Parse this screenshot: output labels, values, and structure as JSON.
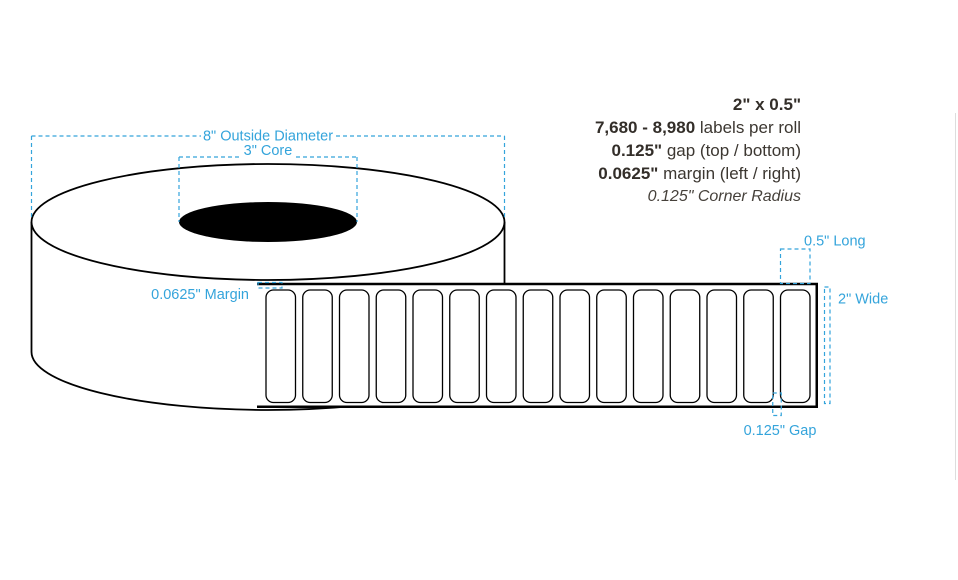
{
  "specs": {
    "size": "2\" x 0.5\"",
    "labels_range": "7,680 - 8,980",
    "labels_suffix": " labels per roll",
    "gap_value": "0.125\"",
    "gap_suffix": " gap (top / bottom)",
    "margin_value": "0.0625\"",
    "margin_suffix": " margin (left / right)",
    "corner_radius_note": "0.125\" Corner Radius"
  },
  "annotations": {
    "outside_diameter": "8\" Outside Diameter",
    "core": "3\" Core",
    "margin": "0.0625\" Margin",
    "long": "0.5\" Long",
    "wide": "2\" Wide",
    "gap": "0.125\" Gap"
  },
  "diagram": {
    "label_count": 15,
    "colors": {
      "annotation_blue": "#34a4db",
      "line_black": "#000000",
      "spec_text": "#3c3731",
      "divider_gray": "#dddddd"
    }
  }
}
